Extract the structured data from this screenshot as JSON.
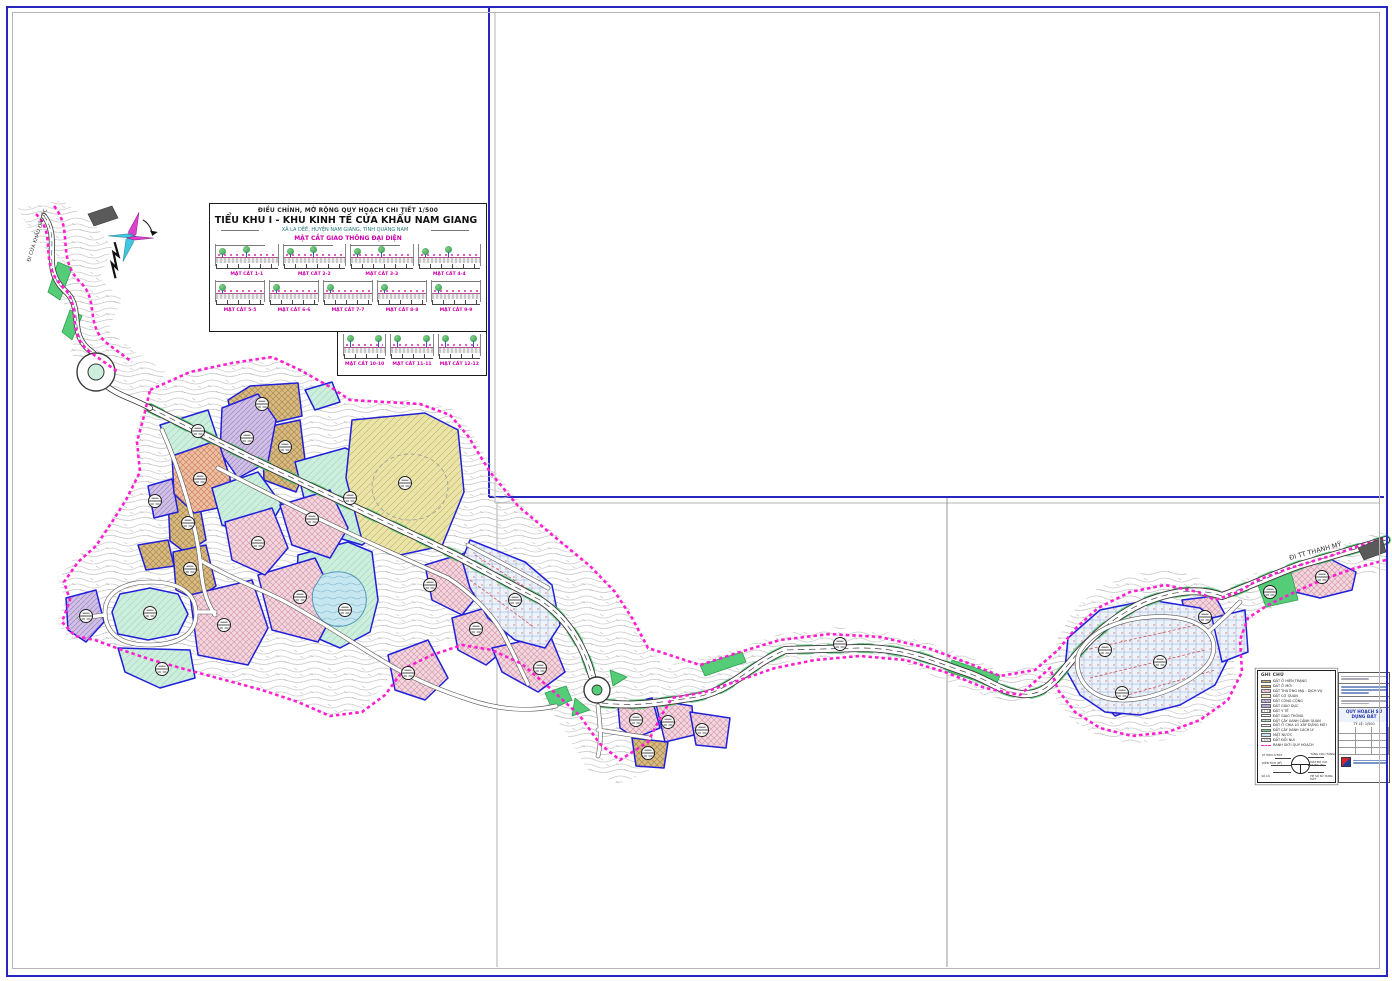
{
  "sheet": {
    "project_type": "ĐIỀU CHỈNH, MỞ RỘNG QUY HOẠCH CHI TIẾT 1/500",
    "title": "TIỂU KHU I - KHU KINH TẾ CỬA KHẨU NAM GIANG",
    "location": "XÃ LA DÊÊ, HUYỆN NAM GIANG, TỈNH QUẢNG NAM",
    "sections_header": "MẶT CẮT GIAO THÔNG ĐẠI DIỆN"
  },
  "cross_sections": {
    "items": [
      {
        "label": "MẶT CẮT 1-1"
      },
      {
        "label": "MẶT CẮT 2-2"
      },
      {
        "label": "MẶT CẮT 3-3"
      },
      {
        "label": "MẶT CẮT 4-4"
      },
      {
        "label": "MẶT CẮT 5-5"
      },
      {
        "label": "MẶT CẮT 6-6"
      },
      {
        "label": "MẶT CẮT 7-7"
      },
      {
        "label": "MẶT CẮT 8-8"
      },
      {
        "label": "MẶT CẮT 9-9"
      },
      {
        "label": "MẶT CẮT 10-10"
      },
      {
        "label": "MẶT CẮT 11-11"
      },
      {
        "label": "MẶT CẮT 12-12"
      }
    ]
  },
  "legend": {
    "title": "GHI CHÚ",
    "items": [
      {
        "label": "ĐẤT Ở HIỆN TRẠNG"
      },
      {
        "label": "ĐẤT Ở MỚI"
      },
      {
        "label": "ĐẤT THƯƠNG MẠI - DỊCH VỤ"
      },
      {
        "label": "ĐẤT CƠ QUAN"
      },
      {
        "label": "ĐẤT CÔNG CỘNG"
      },
      {
        "label": "ĐẤT GIÁO DỤC"
      },
      {
        "label": "ĐẤT Y TẾ"
      },
      {
        "label": "ĐẤT GIAO THÔNG"
      },
      {
        "label": "ĐẤT CÂY XANH CẢNH QUAN"
      },
      {
        "label": "ĐẤT Ở CHIA LÔ XÂY DỰNG MỚI"
      },
      {
        "label": "ĐẤT CÂY XANH CÁCH LY"
      },
      {
        "label": "MẶT NƯỚC"
      },
      {
        "label": "ĐẤT ĐỒI NÚI"
      },
      {
        "label": "RANH GIỚI QUY HOẠCH"
      }
    ]
  },
  "symbol_key": {
    "labels": [
      "KÝ HIỆU Ô ĐẤT",
      "DIỆN TÍCH (M²)",
      "MẬT ĐỘ XÂY DỰNG (%)",
      "TẦNG CAO (TẦNG)",
      "HỆ SỐ SỬ DỤNG ĐẤT",
      "SỐ LÔ"
    ]
  },
  "title_block": {
    "drawing_name": "QUY HOẠCH SỬ DỤNG ĐẤT",
    "scale": "TỶ LỆ: 1/500"
  },
  "map_labels": {
    "road_ne": "ĐI TT THẠNH MỸ",
    "road_nw": "ĐI CỬA KHẨU ĐẮC ỐC"
  },
  "colors": {
    "boundary": "#ff1fd0",
    "parcel_outline": "#2020d8",
    "residential_new": "#f2d7de",
    "residential_existing": "#d8bb80",
    "commercial": "#edbfa4",
    "public": "#cfc0e4",
    "office": "#eae4a8",
    "green": "#cdeedd",
    "green_strip": "#44cc66",
    "water": "#c6e6f0",
    "subdivision": "#eef3fa",
    "terrain": "#c6c6c6",
    "frame": "#2726c0"
  }
}
